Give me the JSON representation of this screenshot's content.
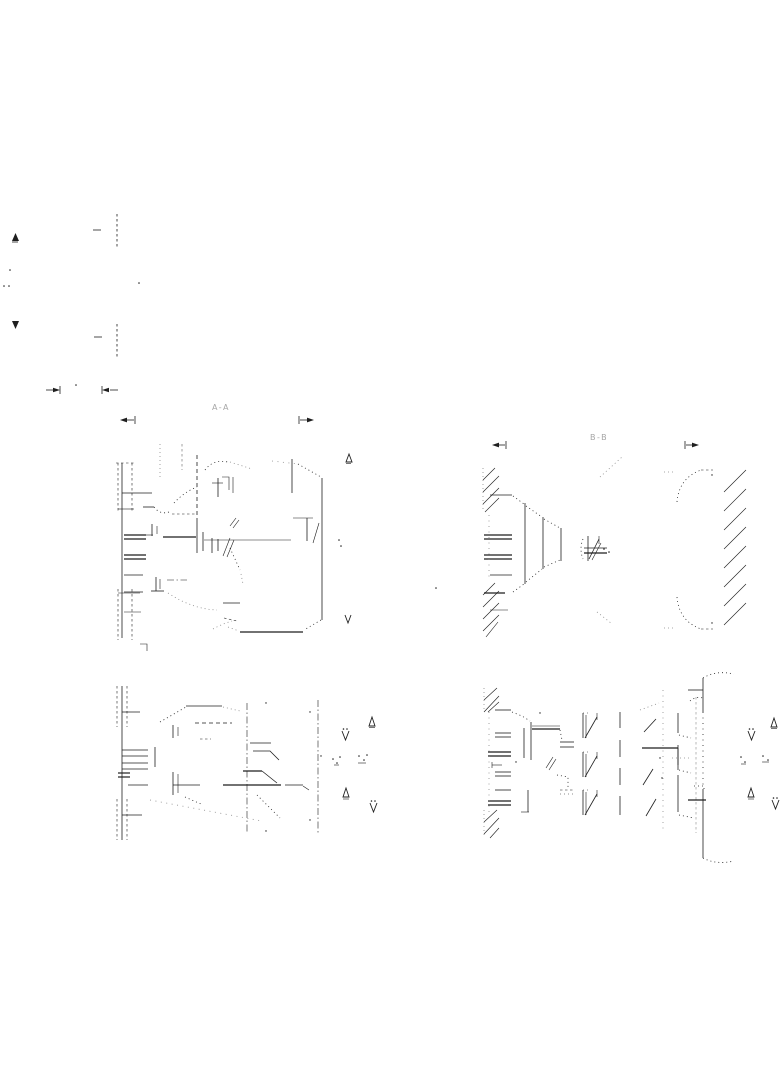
{
  "page": {
    "background": "#ffffff",
    "width": 784,
    "height": 1066
  },
  "drawing": {
    "labels": {
      "section_left": "A-A",
      "section_right": "B-B"
    },
    "line_color": "#1f1f1f",
    "faint_label_color": "#a6a6a6",
    "icons": {
      "section_arrow_up": "triangle-up-outline",
      "section_arrow_down": "triangle-down-outline",
      "view_direction_left": "left-arrow-with-tick",
      "view_direction_right": "right-arrow-with-tick",
      "dimension_arrow": "filled-arrowhead-with-extension-tick"
    }
  }
}
